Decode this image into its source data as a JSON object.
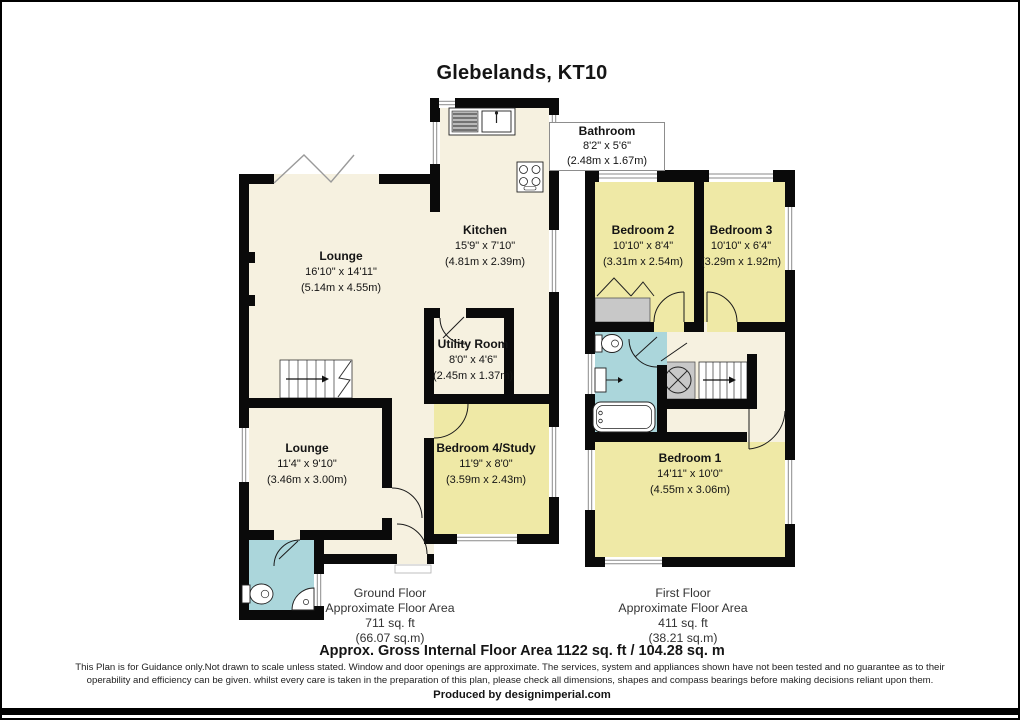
{
  "title": "Glebelands, KT10",
  "ground_floor": {
    "rooms": {
      "kitchen": {
        "name": "Kitchen",
        "imperial": "15'9\" x 7'10\"",
        "metric": "(4.81m x 2.39m)"
      },
      "lounge_main": {
        "name": "Lounge",
        "imperial": "16'10\" x 14'11\"",
        "metric": "(5.14m x 4.55m)"
      },
      "lounge_small": {
        "name": "Lounge",
        "imperial": "11'4\" x 9'10\"",
        "metric": "(3.46m x 3.00m)"
      },
      "utility_room": {
        "name": "Utility Room",
        "imperial": "8'0\" x 4'6\"",
        "metric": "(2.45m x 1.37m)"
      },
      "bedroom4_study": {
        "name": "Bedroom 4/Study",
        "imperial": "11'9\" x 8'0\"",
        "metric": "(3.59m x 2.43m)"
      }
    },
    "summary": {
      "floor_name": "Ground Floor",
      "area_label": "Approximate Floor Area",
      "area_imperial": "711 sq. ft",
      "area_metric": "(66.07 sq.m)"
    }
  },
  "first_floor": {
    "rooms": {
      "bathroom": {
        "name": "Bathroom",
        "imperial": "8'2\" x 5'6\"",
        "metric": "(2.48m x 1.67m)"
      },
      "bedroom2": {
        "name": "Bedroom 2",
        "imperial": "10'10\" x 8'4\"",
        "metric": "(3.31m x 2.54m)"
      },
      "bedroom3": {
        "name": "Bedroom 3",
        "imperial": "10'10\" x 6'4\"",
        "metric": "(3.29m x 1.92m)"
      },
      "bedroom1": {
        "name": "Bedroom 1",
        "imperial": "14'11\" x 10'0\"",
        "metric": "(4.55m x 3.06m)"
      }
    },
    "summary": {
      "floor_name": "First Floor",
      "area_label": "Approximate Floor Area",
      "area_imperial": "411 sq. ft",
      "area_metric": "(38.21 sq.m)"
    }
  },
  "footer": {
    "total_area": "Approx. Gross Internal Floor Area 1122 sq. ft /  104.28 sq. m",
    "disclaimer_line1": "This Plan is for Guidance only.Not drawn to scale unless stated. Window and door openings are approximate. The services, system and appliances shown have not been tested and no guarantee as to their",
    "disclaimer_line2": "operability and efficiency can be given. whilst every care is taken in the preparation of this plan, please check all dimensions, shapes and compass bearings before making decisions reliant upon them.",
    "produced_by": "Produced by designimperial.com"
  },
  "colors": {
    "room_cream": "#F6F1E0",
    "room_yellow": "#EFE9A6",
    "room_cyan": "#ABD6DB",
    "wall": "#0A0A0A",
    "fixture_gray": "#C8C8C8"
  }
}
